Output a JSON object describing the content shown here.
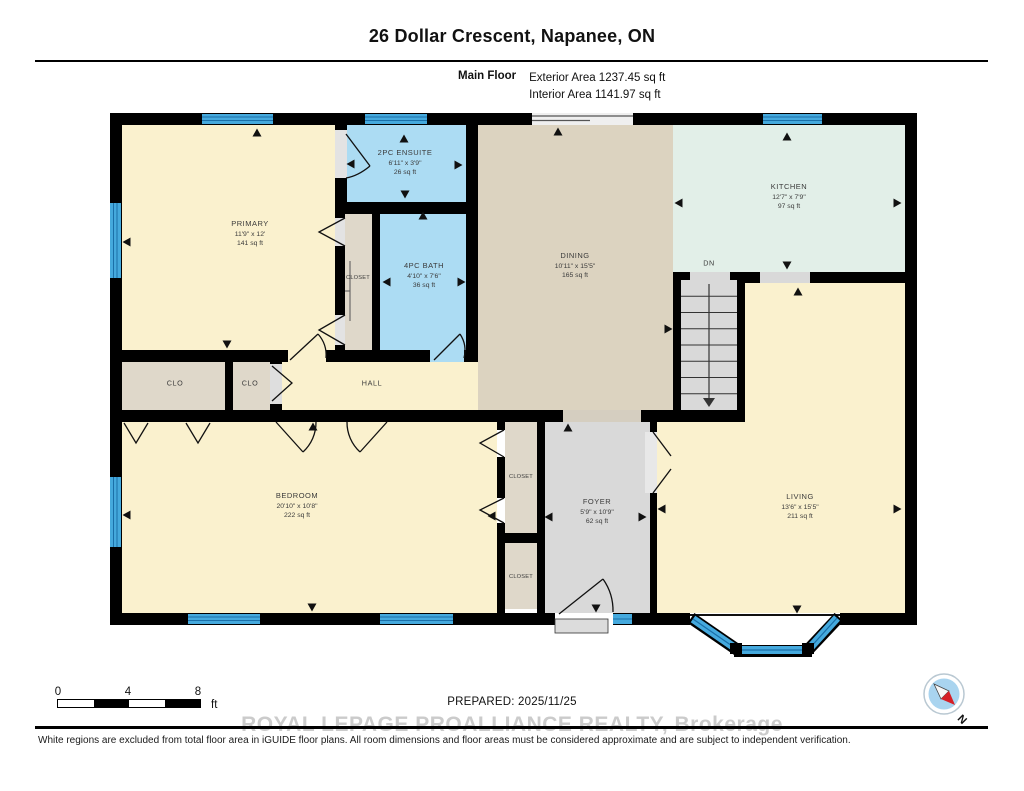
{
  "header": {
    "title": "26 Dollar Crescent, Napanee, ON",
    "floor_label": "Main Floor",
    "exterior_area": "Exterior Area 1237.45 sq ft",
    "interior_area": "Interior Area 1141.97 sq ft"
  },
  "rooms": {
    "primary": {
      "name": "PRIMARY",
      "dims": "11'9\" x 12'",
      "area": "141 sq ft"
    },
    "ensuite": {
      "name": "2PC ENSUITE",
      "dims": "6'11\" x 3'9\"",
      "area": "26 sq ft"
    },
    "bath": {
      "name": "4PC BATH",
      "dims": "4'10\" x 7'6\"",
      "area": "36 sq ft"
    },
    "dining": {
      "name": "DINING",
      "dims": "10'11\" x 15'5\"",
      "area": "165 sq ft"
    },
    "kitchen": {
      "name": "KITCHEN",
      "dims": "12'7\" x 7'9\"",
      "area": "97 sq ft"
    },
    "bedroom": {
      "name": "BEDROOM",
      "dims": "20'10\" x 10'8\"",
      "area": "222 sq ft"
    },
    "foyer": {
      "name": "FOYER",
      "dims": "5'9\" x 10'9\"",
      "area": "62 sq ft"
    },
    "living": {
      "name": "LIVING",
      "dims": "13'6\" x 15'5\"",
      "area": "211 sq ft"
    }
  },
  "labels": {
    "closet_primary": "CLOSET",
    "clo_left": "CLO",
    "clo_right": "CLO",
    "hall": "HALL",
    "closet_top": "CLOSET",
    "closet_bottom": "CLOSET",
    "stairs": "DN",
    "compass_north": "N"
  },
  "footer": {
    "scale_ticks": [
      "0",
      "4",
      "8"
    ],
    "scale_unit": "ft",
    "prepared": "PREPARED: 2025/11/25",
    "watermark": "ROYAL LEPAGE PROALLIANCE REALTY, Brokerage",
    "disclaimer": "White regions are excluded from total floor area in iGUIDE floor plans. All room dimensions and floor areas must be considered approximate and are subject to independent verification."
  },
  "colors": {
    "room_yellow": "#FAF1CE",
    "room_tan": "#DCD3C0",
    "room_mint": "#E2EFE8",
    "room_blue": "#ACDCF3",
    "room_gray": "#D9D9D9",
    "closet_beige": "#DFD8CA",
    "wall": "#000000",
    "window_blue": "#45A9DD"
  }
}
